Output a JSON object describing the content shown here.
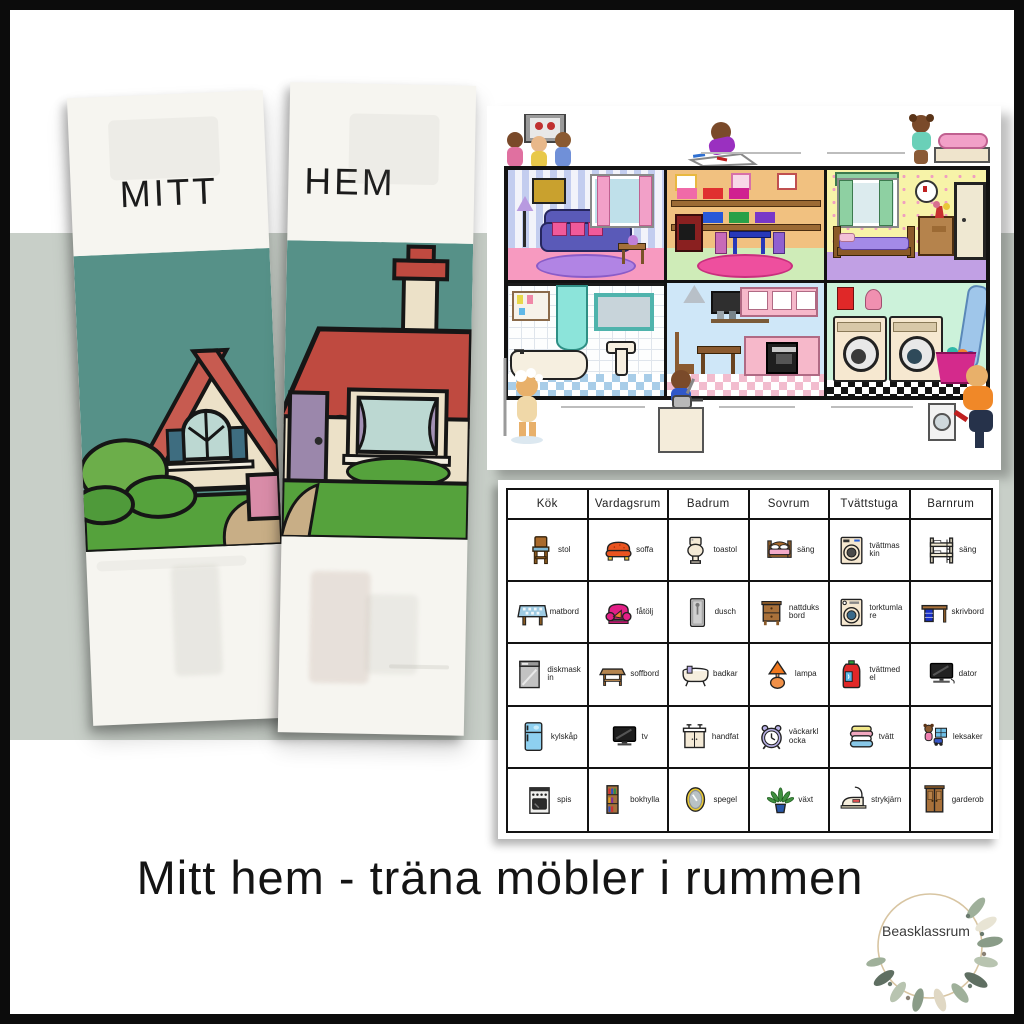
{
  "page": {
    "caption": "Mitt hem - träna möbler i rummen",
    "brand": "Beasklassrum"
  },
  "lapbook": {
    "title_left": "MITT",
    "title_right": "HEM"
  },
  "dollhouse": {
    "rooms": [
      "living-room",
      "playroom",
      "bedroom",
      "bathroom",
      "kitchen",
      "laundry-room"
    ]
  },
  "vocab_table": {
    "columns": [
      {
        "header": "Kök",
        "items": [
          {
            "label": "stol",
            "icon": "chair-icon"
          },
          {
            "label": "matbord",
            "icon": "dining-table-icon"
          },
          {
            "label": "diskmaskin",
            "icon": "dishwasher-icon"
          },
          {
            "label": "kylskåp",
            "icon": "fridge-icon"
          },
          {
            "label": "spis",
            "icon": "stove-icon"
          }
        ]
      },
      {
        "header": "Vardagsrum",
        "items": [
          {
            "label": "soffa",
            "icon": "sofa-icon"
          },
          {
            "label": "fåtölj",
            "icon": "armchair-icon"
          },
          {
            "label": "soffbord",
            "icon": "coffee-table-icon"
          },
          {
            "label": "tv",
            "icon": "tv-icon"
          },
          {
            "label": "bokhylla",
            "icon": "bookshelf-icon"
          }
        ]
      },
      {
        "header": "Badrum",
        "items": [
          {
            "label": "toastol",
            "icon": "toilet-icon"
          },
          {
            "label": "dusch",
            "icon": "shower-icon"
          },
          {
            "label": "badkar",
            "icon": "bathtub-icon"
          },
          {
            "label": "handfat",
            "icon": "sink-icon"
          },
          {
            "label": "spegel",
            "icon": "mirror-icon"
          }
        ]
      },
      {
        "header": "Sovrum",
        "items": [
          {
            "label": "säng",
            "icon": "bed-icon"
          },
          {
            "label": "nattduksbord",
            "icon": "nightstand-icon"
          },
          {
            "label": "lampa",
            "icon": "lamp-icon"
          },
          {
            "label": "väckarklocka",
            "icon": "alarm-clock-icon"
          },
          {
            "label": "växt",
            "icon": "plant-icon"
          }
        ]
      },
      {
        "header": "Tvättstuga",
        "items": [
          {
            "label": "tvättmaskin",
            "icon": "washing-machine-icon"
          },
          {
            "label": "torktumlare",
            "icon": "dryer-icon"
          },
          {
            "label": "tvättmedel",
            "icon": "detergent-icon"
          },
          {
            "label": "tvätt",
            "icon": "laundry-pile-icon"
          },
          {
            "label": "strykjärn",
            "icon": "iron-icon"
          }
        ]
      },
      {
        "header": "Barnrum",
        "items": [
          {
            "label": "säng",
            "icon": "bunk-bed-icon"
          },
          {
            "label": "skrivbord",
            "icon": "desk-icon"
          },
          {
            "label": "dator",
            "icon": "computer-icon"
          },
          {
            "label": "leksaker",
            "icon": "toys-icon"
          },
          {
            "label": "garderob",
            "icon": "wardrobe-icon"
          }
        ]
      }
    ]
  },
  "colors": {
    "band": "#c8cfc8",
    "frame": "#0c0c0c",
    "sky_teal": "#569188",
    "roof_red": "#bf4a40",
    "grass_green": "#55a23c",
    "accent_pink": "#f05a9a"
  }
}
